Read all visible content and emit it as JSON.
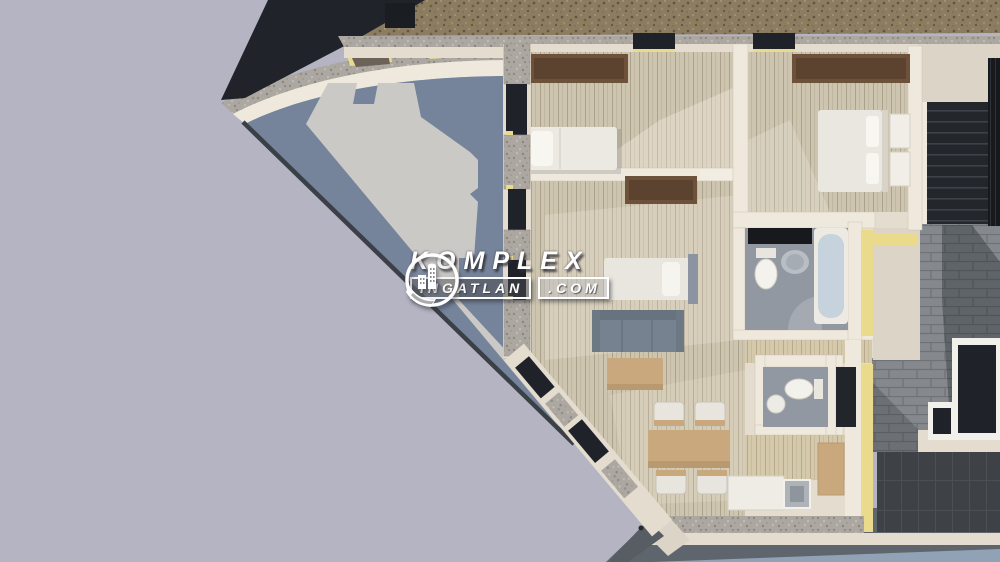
{
  "watermark": {
    "brand": "KOMPLEX",
    "domain_name": "INGATLAN",
    "domain_tld": ".COM",
    "logo_icon": "buildings-circle-arrow-icon"
  },
  "colors": {
    "background": "#B5B4C3",
    "terrace": "#75849B",
    "terrace_shadow": "#CBC9C5",
    "wall_cream": "#E4DDCF",
    "wall_bright": "#EFE9DD",
    "wood_floor": "#CEC5B0",
    "wood_warm": "#D5C9AC",
    "gravel_brown": "#8C7C60",
    "stone_gray": "#ACA8A1",
    "glass": "#1F2329",
    "roof_brick": "#85898D",
    "roof_dark": "#3E4246",
    "stairs_dark": "#23262B",
    "insulation": "#E9DA8C",
    "furniture_wood": "#6E513B",
    "table_tan": "#C9A87D",
    "sofa": "#76828F",
    "bath_floor": "#9298A1",
    "ground": "#91A1B6",
    "ground_shadow": "#5E656C",
    "watermark_white": "#FFFFFF"
  }
}
